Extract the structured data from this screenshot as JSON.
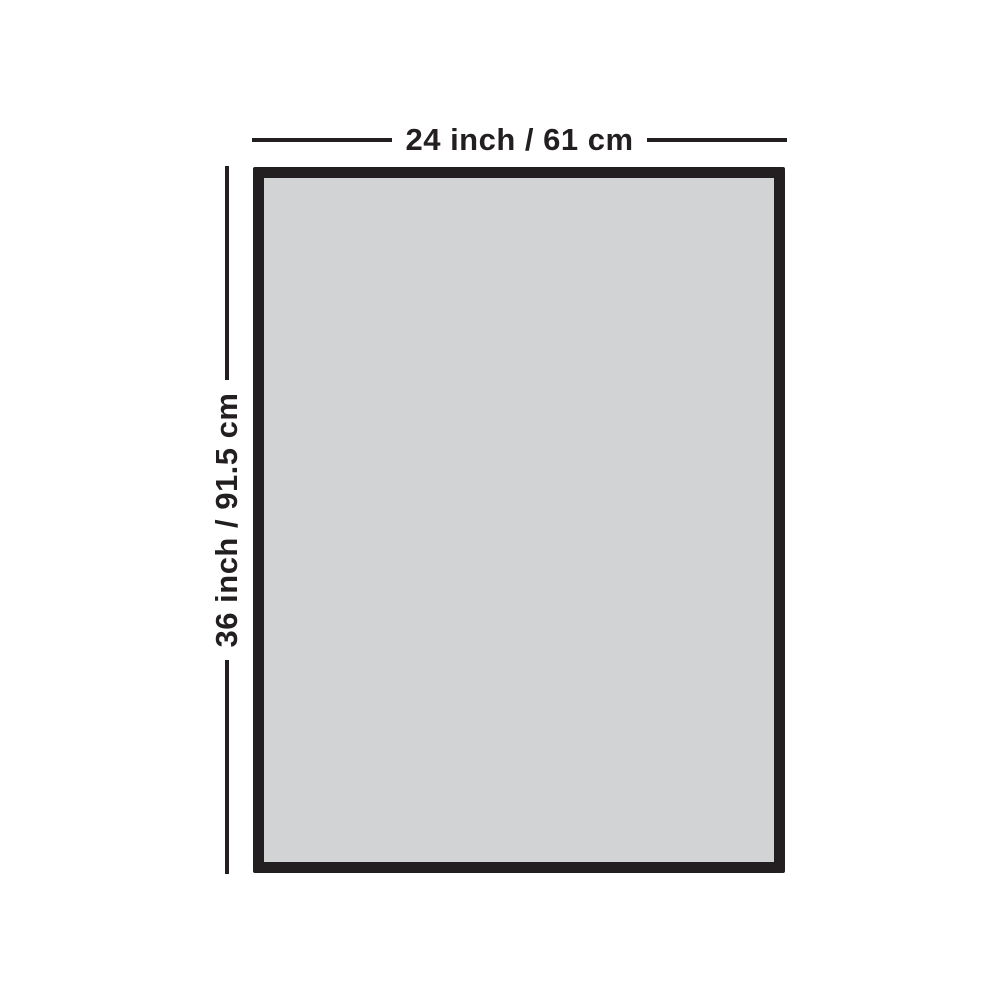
{
  "diagram": {
    "type": "product-dimension-diagram",
    "dimensions": {
      "width": {
        "label": "24 inch / 61 cm",
        "inches": 24,
        "cm": 61
      },
      "height": {
        "label": "36 inch / 91.5 cm",
        "inches": 36,
        "cm": 91.5
      }
    },
    "colors": {
      "bg": "#ffffff",
      "frame": "#231f20",
      "fill": "#d1d3d4",
      "line": "#231f20",
      "text": "#231f20"
    }
  }
}
